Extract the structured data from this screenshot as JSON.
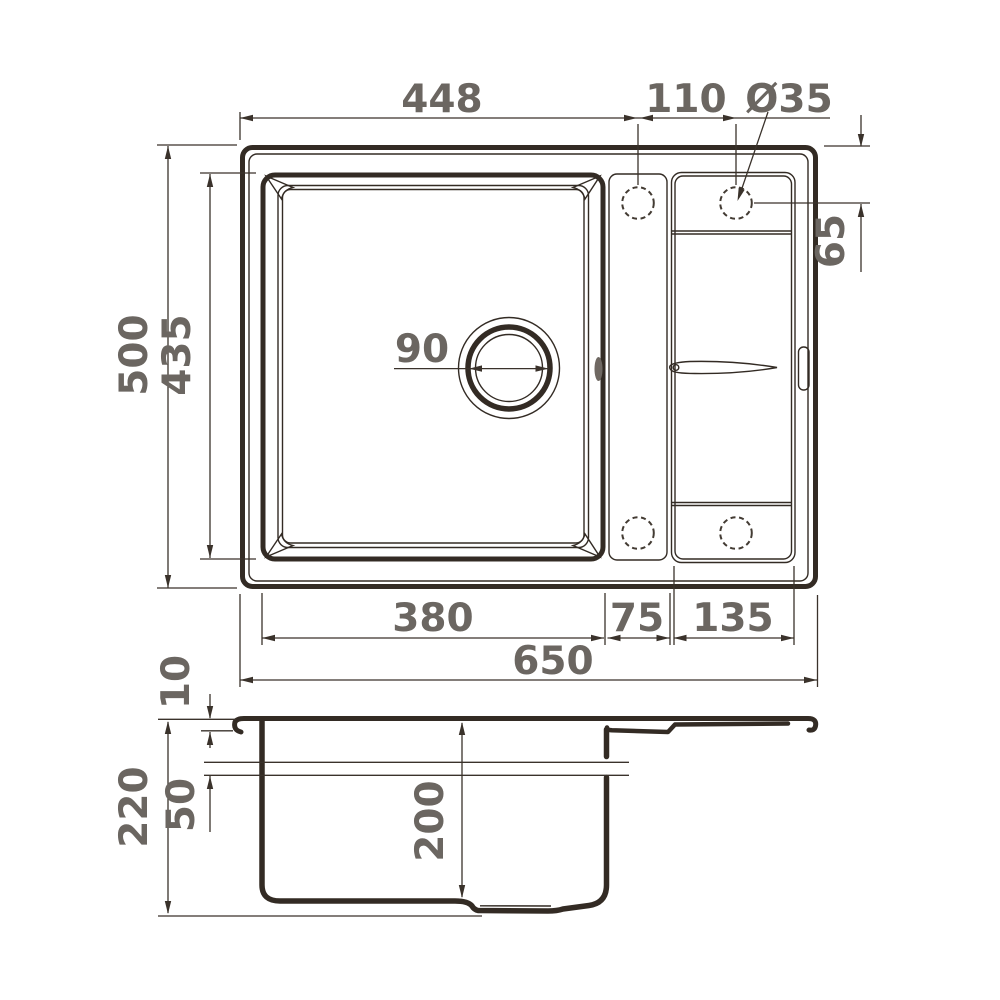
{
  "dims": {
    "total_width": "650",
    "bowl_edge_to_tap": "448",
    "tap_spacing": "110",
    "tap_hole_diameter": "Ø35",
    "tap_edge_offset": "65",
    "total_depth": "500",
    "bowl_length": "435",
    "drain_diameter": "90",
    "bowl_width": "380",
    "divider_width": "75",
    "drainboard_width": "135",
    "overall_height": "220",
    "rim_height": "10",
    "overflow_level": "50",
    "bowl_depth": "200"
  },
  "colors": {
    "line": "#332b24",
    "dimension": "#3a322b",
    "label_text": "#6b6661",
    "background": "#ffffff"
  }
}
